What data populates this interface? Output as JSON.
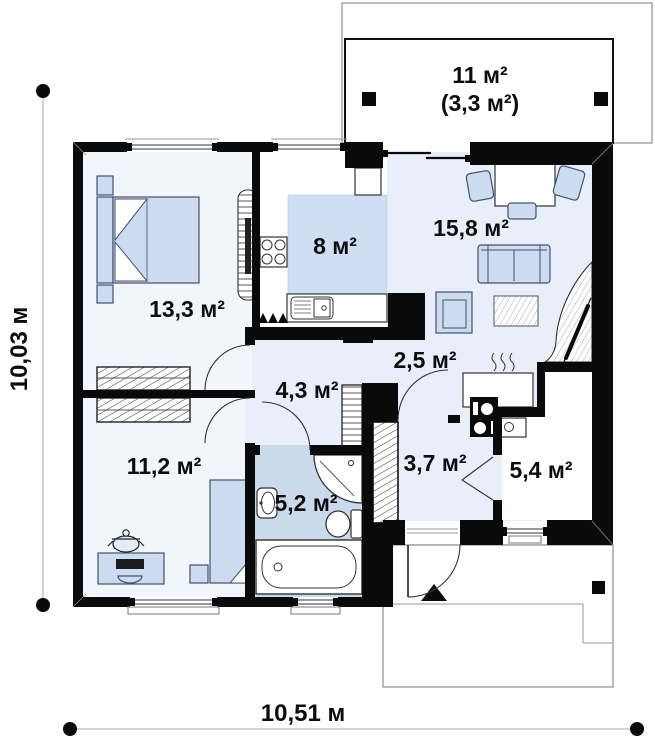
{
  "floor_plan": {
    "rooms": {
      "terrace": {
        "area_label": "11 м²",
        "area_secondary_label": "(3,3 м²)"
      },
      "bedroom_main": {
        "area_label": "13,3 м²"
      },
      "kitchen": {
        "area_label": "8 м²"
      },
      "living_room": {
        "area_label": "15,8 м²"
      },
      "hall": {
        "area_label": "2,5 м²"
      },
      "corridor": {
        "area_label": "4,3 м²"
      },
      "bedroom_second": {
        "area_label": "11,2 м²"
      },
      "bathroom": {
        "area_label": "5,2 м²"
      },
      "vestibule": {
        "area_label": "3,7 м²"
      },
      "boiler_room": {
        "area_label": "5,4 м²"
      }
    },
    "dimensions": {
      "total_width_label": "10,51 м",
      "total_depth_label": "10,03 м"
    },
    "colors": {
      "wall": "#0a0a0a",
      "floor_main": "#e8effa",
      "floor_bedroom": "#f1f6fd",
      "floor_bathroom": "#cbd9ed",
      "kitchen_zone": "#cfdef2",
      "furniture_fill": "#ccdbf0",
      "furniture_stroke": "#42506b"
    }
  }
}
